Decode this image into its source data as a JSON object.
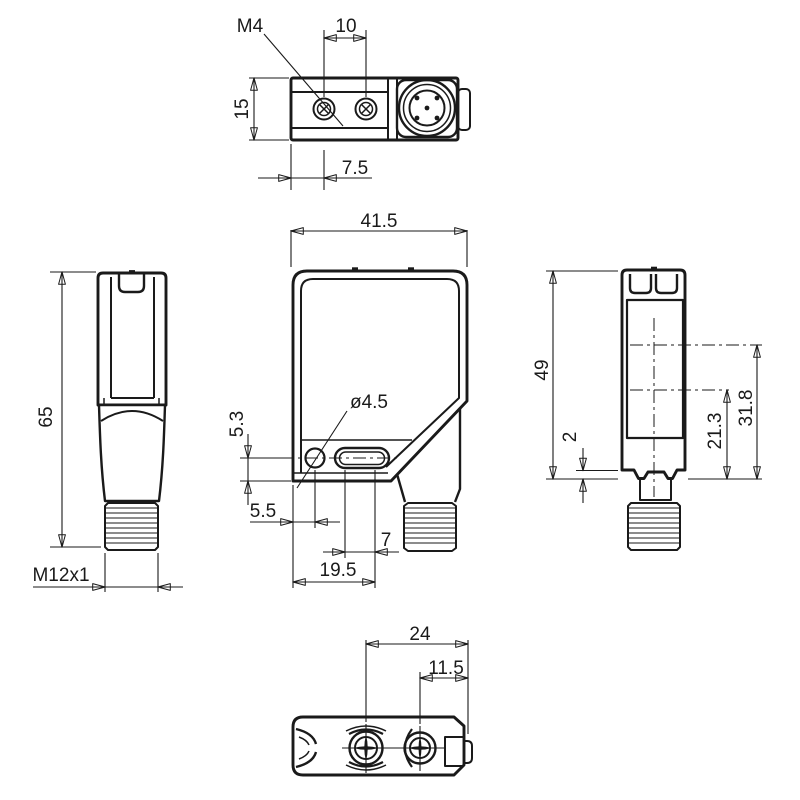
{
  "drawing": {
    "title": "Photoelectric sensor dimensional drawing",
    "units": "mm",
    "colors": {
      "line": "#1a1a1a",
      "background": "#ffffff"
    },
    "views": {
      "top": {
        "labels": {
          "mounting_thread": "M4",
          "hole_spacing": "10",
          "depth": "15",
          "hole_offset": "7.5"
        }
      },
      "front": {
        "labels": {
          "width": "41.5",
          "hole_diameter": "ø4.5",
          "hole_center_height": "5.3",
          "hole_center_x": "5.5",
          "slot_length": "7",
          "slot_end_offset": "19.5"
        }
      },
      "left": {
        "labels": {
          "total_height": "65",
          "connector_thread": "M12x1"
        }
      },
      "right": {
        "labels": {
          "housing_height": "49",
          "step_height": "2",
          "lower_axis_height": "21.3",
          "upper_axis_height": "31.8"
        }
      },
      "bottom": {
        "labels": {
          "lens_center_to_edge": "24",
          "front_lens_center_to_edge": "11.5"
        }
      }
    }
  }
}
